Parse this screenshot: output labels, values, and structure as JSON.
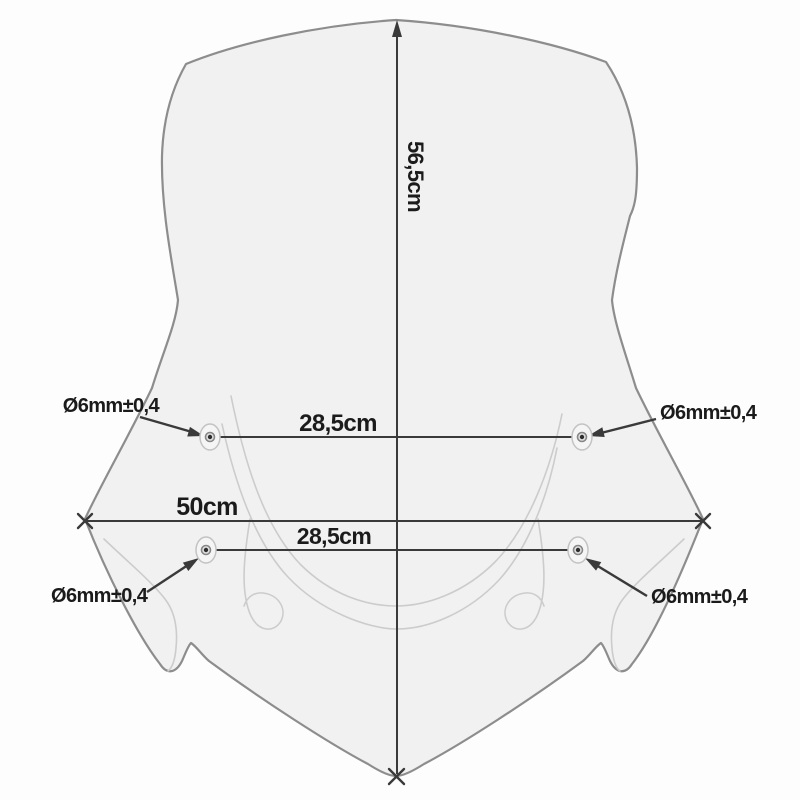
{
  "diagram_labels": {
    "height": "56,5cm",
    "width": "50cm",
    "top_hole_span": "28,5cm",
    "bottom_hole_span": "28,5cm",
    "top_left_hole": "Ø6mm±0,4",
    "top_right_hole": "Ø6mm±0,4",
    "bottom_left_hole": "Ø6mm±0,4",
    "bottom_right_hole": "Ø6mm±0,4"
  },
  "measurements": {
    "height_cm": "56,5",
    "width_cm": "50",
    "hole_span_cm": "28,5",
    "hole_diameter": "Ø6mm",
    "hole_tolerance": "±0,4"
  },
  "colors": {
    "background": "#fdfdfd",
    "screen_fill": "#f1f1f1",
    "screen_outline": "#8d8d8d",
    "contour_line": "#cccccc",
    "dimension_line": "#3a3a3a",
    "label_text": "#1b1b1b"
  }
}
